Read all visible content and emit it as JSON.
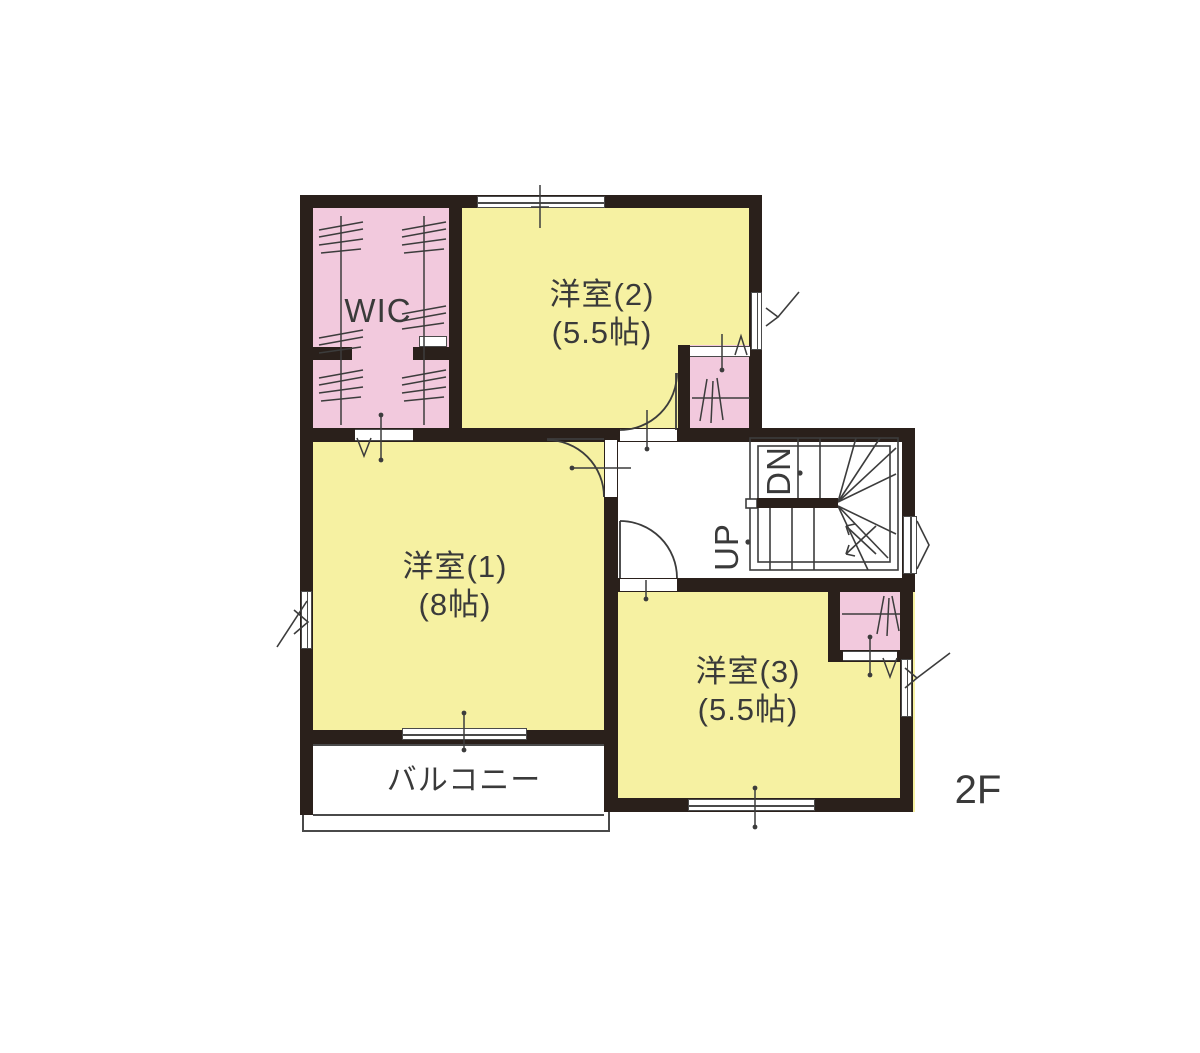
{
  "floor_label": "2F",
  "colors": {
    "room_yellow": "#F6F1A2",
    "closet_pink": "#F2C9DD",
    "wall": "#2A201B",
    "line": "#3C3C3C",
    "text": "#3A3A3A"
  },
  "rooms": {
    "wic": {
      "label": "WIC"
    },
    "room1": {
      "name": "洋室(1)",
      "size": "(8帖)"
    },
    "room2": {
      "name": "洋室(2)",
      "size": "(5.5帖)"
    },
    "room3": {
      "name": "洋室(3)",
      "size": "(5.5帖)"
    },
    "balcony": {
      "label": "バルコニー"
    }
  },
  "stairs": {
    "up": "UP",
    "down": "DN"
  }
}
